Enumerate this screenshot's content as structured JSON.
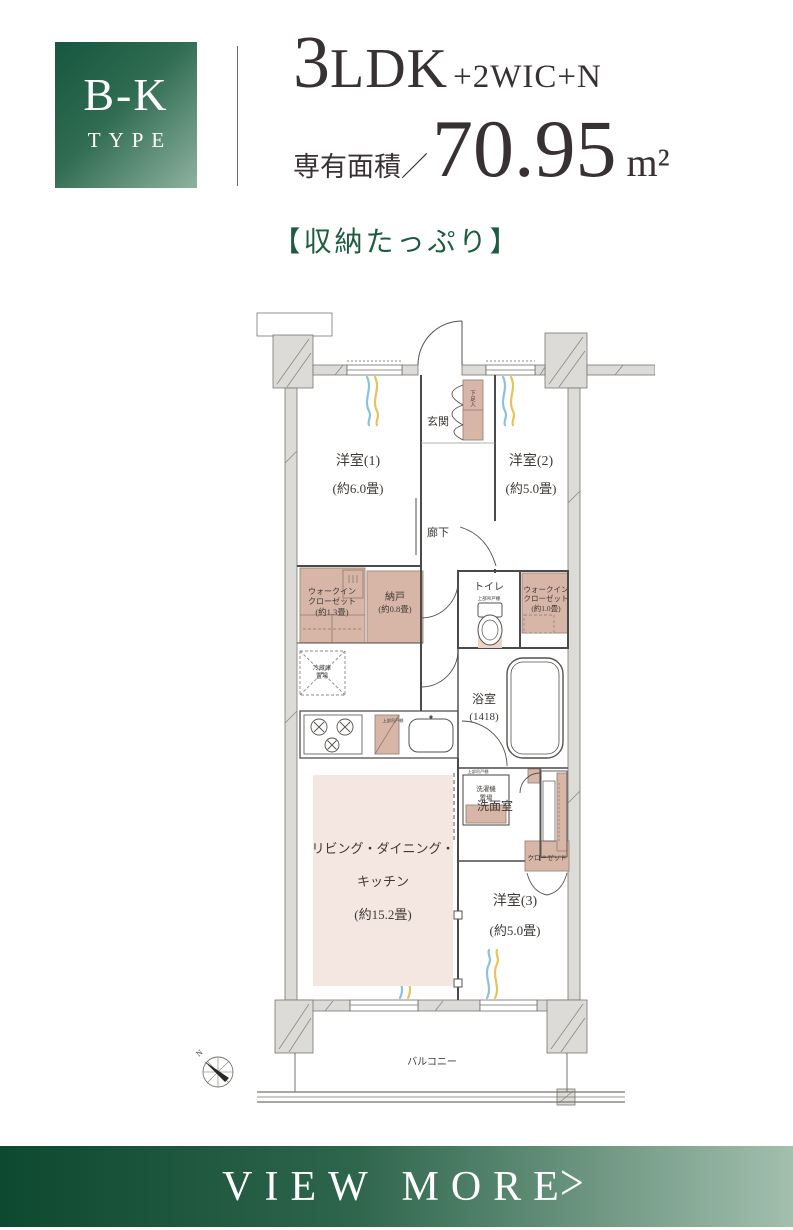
{
  "header": {
    "type_label": "B-K",
    "type_sub": "TYPE",
    "layout_num": "3",
    "layout_unit": "LDK",
    "layout_extra": "+2WIC+N",
    "area_label": "専有面積／",
    "area_value": "70.95",
    "area_unit": "m²",
    "catch_copy": "【収納たっぷり】"
  },
  "colors": {
    "accent_green_dark": "#0d4830",
    "accent_green_light": "#a3bfae",
    "catch_green": "#1c5c40",
    "plan_storage_pink": "#d7b5a7",
    "plan_ldk_pink": "#f4e7e1",
    "plan_wall_gray": "#dcdbd7",
    "curtain_blue": "#8ec1da",
    "curtain_yellow": "#e6c35b"
  },
  "floorplan": {
    "labels": [
      {
        "name": "label-genkan",
        "t": "玄関",
        "x": 243,
        "y": 122,
        "s": 11
      },
      {
        "name": "label-shoebox",
        "t": "下足入",
        "x": 278,
        "y": 92,
        "s": 5.5,
        "v": true
      },
      {
        "name": "label-room1-name",
        "t": "洋室(1)",
        "x": 163,
        "y": 162,
        "s": 14
      },
      {
        "name": "label-room1-size",
        "t": "(約6.0畳)",
        "x": 163,
        "y": 190,
        "s": 13
      },
      {
        "name": "label-room2-name",
        "t": "洋室(2)",
        "x": 336,
        "y": 162,
        "s": 14
      },
      {
        "name": "label-room2-size",
        "t": "(約5.0畳)",
        "x": 336,
        "y": 190,
        "s": 13
      },
      {
        "name": "label-hallway",
        "t": "廊下",
        "x": 243,
        "y": 233,
        "s": 11
      },
      {
        "name": "label-wic1-line1",
        "t": "ウォークイン",
        "x": 137,
        "y": 291,
        "s": 8
      },
      {
        "name": "label-wic1-line2",
        "t": "クローゼット",
        "x": 137,
        "y": 301,
        "s": 8
      },
      {
        "name": "label-wic1-size",
        "t": "(約1.3畳)",
        "x": 137,
        "y": 312,
        "s": 8.5
      },
      {
        "name": "label-nando-name",
        "t": "納戸",
        "x": 200,
        "y": 297,
        "s": 10
      },
      {
        "name": "label-nando-size",
        "t": "(約0.8畳)",
        "x": 200,
        "y": 309,
        "s": 8.5
      },
      {
        "name": "label-toilet",
        "t": "トイレ",
        "x": 294,
        "y": 287,
        "s": 10
      },
      {
        "name": "label-toilet-shelf",
        "t": "上部吊戸棚",
        "x": 294,
        "y": 297,
        "s": 4.5
      },
      {
        "name": "label-wic2-line1",
        "t": "ウォークイン",
        "x": 351,
        "y": 289,
        "s": 7.5
      },
      {
        "name": "label-wic2-line2",
        "t": "クローゼット",
        "x": 351,
        "y": 298,
        "s": 7.5
      },
      {
        "name": "label-wic2-size",
        "t": "(約1.0畳)",
        "x": 351,
        "y": 308,
        "s": 7.5
      },
      {
        "name": "label-fridge-line1",
        "t": "冷蔵庫",
        "x": 127,
        "y": 367,
        "s": 6
      },
      {
        "name": "label-fridge-line2",
        "t": "置場",
        "x": 127,
        "y": 375,
        "s": 6
      },
      {
        "name": "label-kitchen-shelf",
        "t": "上部吊戸棚",
        "x": 198,
        "y": 419,
        "s": 4.2
      },
      {
        "name": "label-bath-name",
        "t": "浴室",
        "x": 289,
        "y": 400,
        "s": 12
      },
      {
        "name": "label-bath-size",
        "t": "(1418)",
        "x": 289,
        "y": 417,
        "s": 11
      },
      {
        "name": "label-washroom",
        "t": "洗面室",
        "x": 300,
        "y": 507,
        "s": 12
      },
      {
        "name": "label-washroom-shelf",
        "t": "上部吊戸棚",
        "x": 283,
        "y": 470,
        "s": 4.2
      },
      {
        "name": "label-washer-line1",
        "t": "洗濯機",
        "x": 291,
        "y": 488,
        "s": 6.5
      },
      {
        "name": "label-washer-line2",
        "t": "置場",
        "x": 291,
        "y": 497,
        "s": 6.5
      },
      {
        "name": "label-closet3",
        "t": "クローゼット",
        "x": 352,
        "y": 557,
        "s": 6.5
      },
      {
        "name": "label-ldk-line1",
        "t": "リビング・ダイニング・",
        "x": 188,
        "y": 550,
        "s": 13
      },
      {
        "name": "label-ldk-line2",
        "t": "キッチン",
        "x": 188,
        "y": 583,
        "s": 13
      },
      {
        "name": "label-ldk-size",
        "t": "(約15.2畳)",
        "x": 188,
        "y": 616,
        "s": 13
      },
      {
        "name": "label-room3-name",
        "t": "洋室(3)",
        "x": 320,
        "y": 602,
        "s": 14
      },
      {
        "name": "label-room3-size",
        "t": "(約5.0畳)",
        "x": 320,
        "y": 632,
        "s": 13
      },
      {
        "name": "label-balcony",
        "t": "バルコニー",
        "x": 237,
        "y": 762,
        "s": 10
      },
      {
        "name": "label-compass-n",
        "t": "N",
        "x": 6,
        "y": 752,
        "s": 8,
        "rot": -40
      }
    ]
  },
  "footer": {
    "view_more": "VIEW MORE",
    "chevron": ">"
  }
}
